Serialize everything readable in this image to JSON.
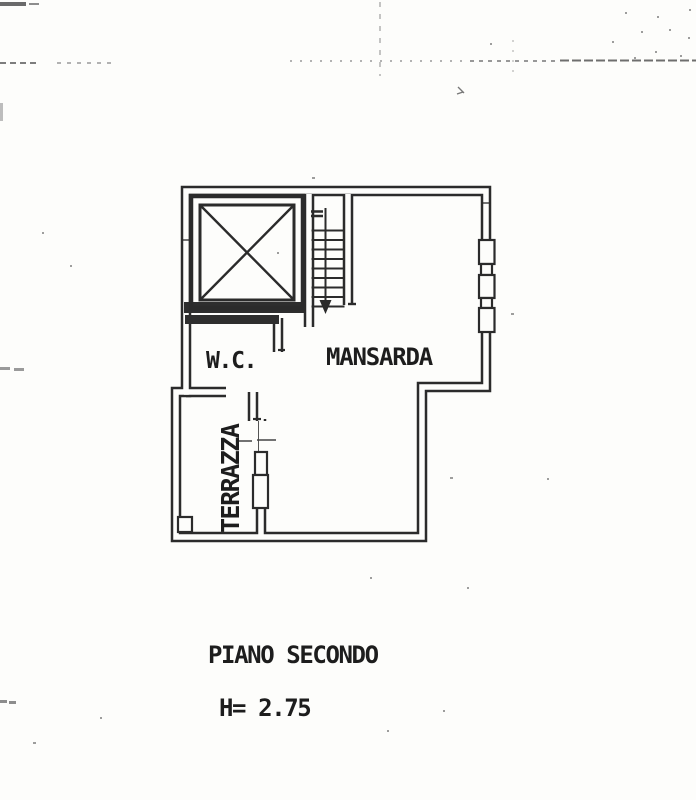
{
  "plan": {
    "rooms": {
      "wc": "W.C.",
      "mansarda": "MANSARDA",
      "terrazza": "TERRAZZA"
    },
    "caption": {
      "floor_label": "PIANO SECONDO",
      "ceiling_height": "H= 2.75"
    },
    "colors": {
      "ink": "#2b2b2b",
      "paper": "#fdfdfb"
    }
  }
}
